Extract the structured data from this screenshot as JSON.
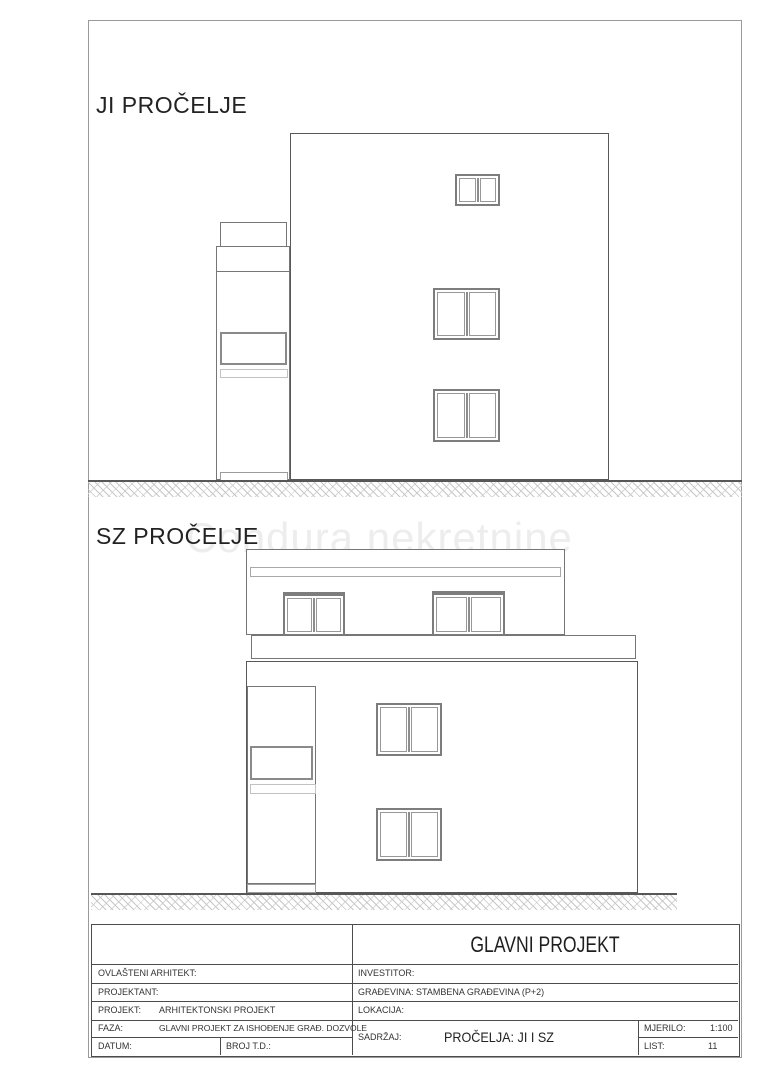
{
  "page": {
    "watermark": "Condura nekretnine"
  },
  "elevations": {
    "ji": {
      "label": "JI PROČELJE"
    },
    "sz": {
      "label": "SZ PROČELJE"
    }
  },
  "title_block": {
    "header": "GLAVNI PROJEKT",
    "ovlasteni_arhitekt_label": "OVLAŠTENI ARHITEKT:",
    "projektant_label": "PROJEKTANT:",
    "projekt_label": "PROJEKT:",
    "projekt_value": "ARHITEKTONSKI PROJEKT",
    "faza_label": "FAZA:",
    "faza_value": "GLAVNI PROJEKT ZA ISHOĐENJE GRAĐ. DOZVOLE",
    "datum_label": "DATUM:",
    "broj_td_label": "BROJ T.D.:",
    "investitor_label": "INVESTITOR:",
    "gradevina_label": "GRAĐEVINA:",
    "gradevina_value": "STAMBENA GRAĐEVINA (P+2)",
    "lokacija_label": "LOKACIJA:",
    "sadrzaj_label": "SADRŽAJ:",
    "sadrzaj_value": "PROČELJA: JI I SZ",
    "mjerilo_label": "MJERILO:",
    "mjerilo_value": "1:100",
    "list_label": "LIST:",
    "list_value": "11"
  },
  "colors": {
    "outline_dark": "#585858",
    "outline_medium": "#767676",
    "outline_light": "#c2c2c2",
    "window_frame": "#7d7d7d",
    "hatch": "#c7c7c7",
    "watermark": "#ededed",
    "text": "#2b2b2b"
  }
}
